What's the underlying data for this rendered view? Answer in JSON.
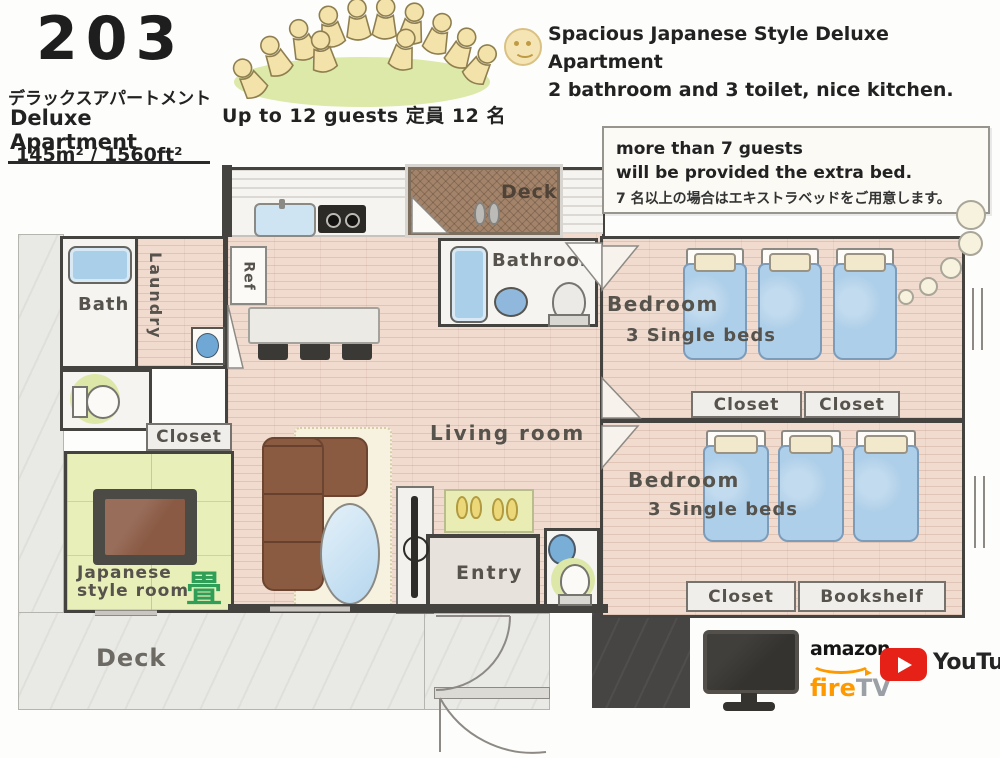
{
  "header": {
    "room_number": "203",
    "subtitle_jp": "デラックスアパートメント",
    "subtitle_en": "Deluxe Apartment",
    "area": "145m² / 1560ft²",
    "capacity": "Up to 12 guests  定員 12 名"
  },
  "tagline": {
    "line1": "Spacious Japanese Style Deluxe Apartment",
    "line2": "2 bathroom and 3 toilet, nice kitchen."
  },
  "note": {
    "line1": "more than 7 guests",
    "line2": "will be provided the extra bed.",
    "line3": "7 名以上の場合はエキストラベッドをご用意します。"
  },
  "plan": {
    "deck_top_label": "Deck",
    "bathroom_label": "Bathroom",
    "bath_label": "Bath",
    "laundry_label": "Laundry",
    "ref_label": "Ref",
    "closet_left_label": "Closet",
    "japanese_room_line1": "Japanese",
    "japanese_room_line2": "style room",
    "tatami_char": "畳",
    "living_label": "Living room",
    "entry_label": "Entry",
    "deck_bottom_label": "Deck",
    "bedroom1": {
      "name": "Bedroom",
      "beds": "3 Single beds",
      "closet1": "Closet",
      "closet2": "Closet"
    },
    "bedroom2": {
      "name": "Bedroom",
      "beds": "3 Single beds",
      "closet": "Closet",
      "bookshelf": "Bookshelf"
    }
  },
  "footer": {
    "amazon_label": "amazon",
    "fire_label": "fire",
    "tv_label": "TV",
    "youtube_label": "YouTube"
  },
  "colors": {
    "wall": "#454340",
    "floor_wood": "#f1dbcf",
    "tatami_green": "#e9efb8",
    "bed_blue": "#aecfe9",
    "deck_brown": "#a3846b",
    "youtube_red": "#e62117",
    "fire_orange": "#ff9900"
  }
}
